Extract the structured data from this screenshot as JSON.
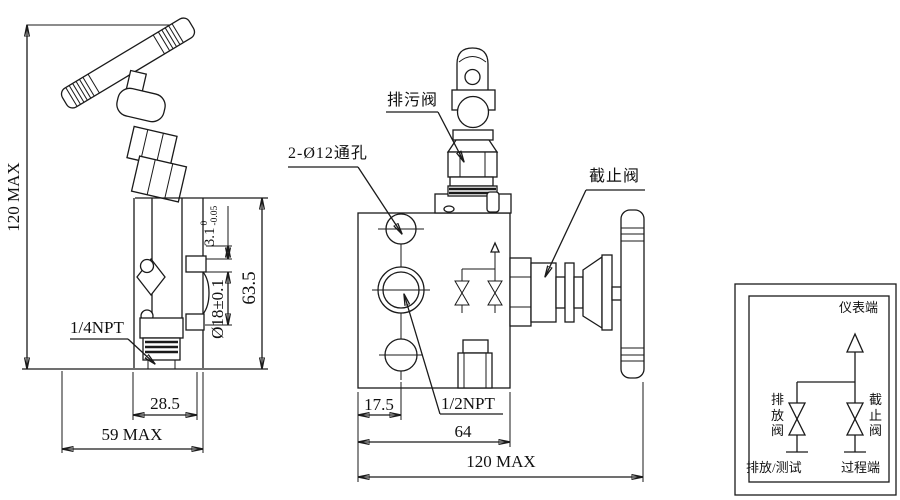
{
  "left_view": {
    "overall_height": "120 MAX",
    "port": "1/4NPT",
    "hole_spacing": "28.5",
    "overall_width": "59 MAX",
    "slot_value": "3.1",
    "slot_tol_upper": "0",
    "slot_tol_lower": "-0.05",
    "bore": "Ø18±0.1",
    "body_height": "63.5"
  },
  "front_view": {
    "drain_valve_label": "排污阀",
    "holes_label": "2-Ø12通孔",
    "stop_valve_label": "截止阀",
    "port": "1/2NPT",
    "hole_offset": "17.5",
    "body_width": "64",
    "overall_width": "120 MAX"
  },
  "schematic": {
    "instrument_end": "仪表端",
    "drain_valve": "排放阀",
    "stop_valve": "截止阀",
    "drain_test": "排放/测试",
    "process_end": "过程端"
  },
  "colors": {
    "line": "#1a1a1a",
    "highlight_border": "#d5294a"
  }
}
